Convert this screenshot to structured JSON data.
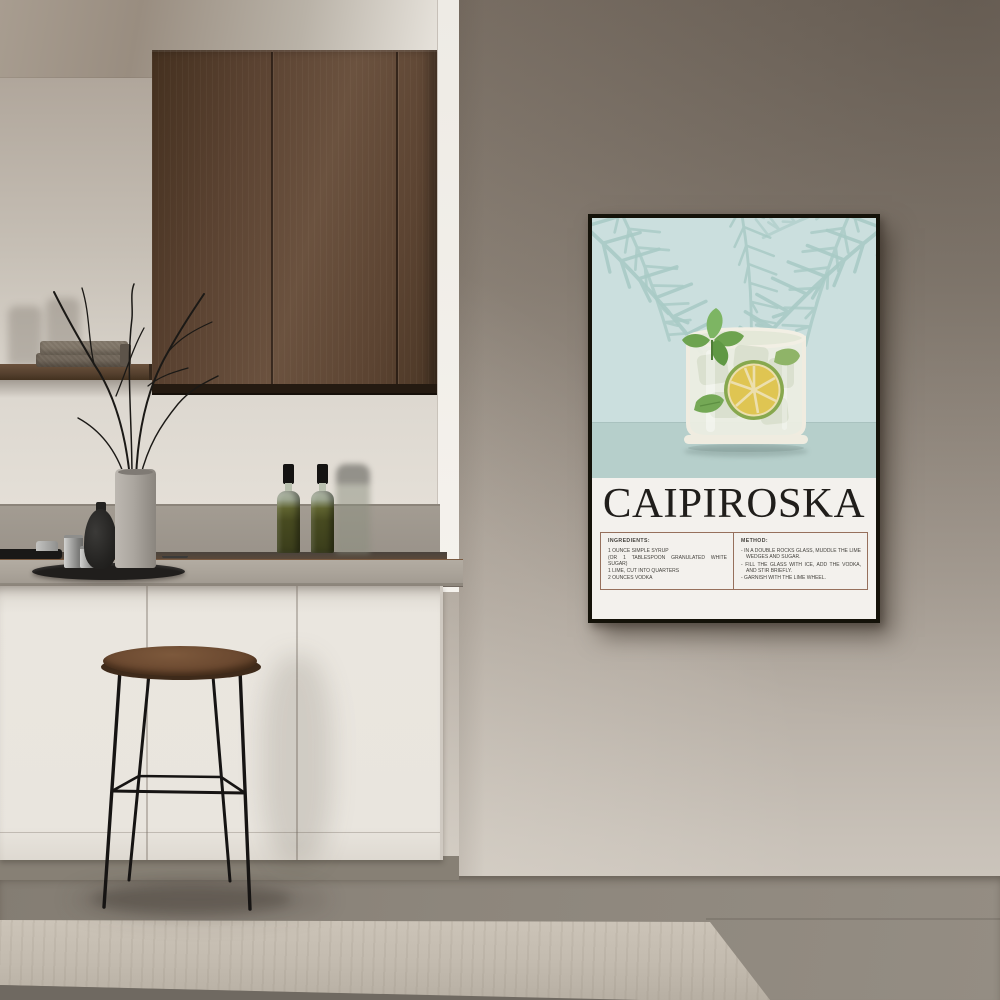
{
  "poster": {
    "title": "CAIPIROSKA",
    "ingredients": {
      "header": "INGREDIENTS:",
      "lines": [
        "1 OUNCE SIMPLE SYRUP",
        "(OR 1 TABLESPOON GRANULATED WHITE SUGAR)",
        "1 LIME, CUT INTO QUARTERS",
        "2 OUNCES VODKA"
      ]
    },
    "method": {
      "header": "METHOD:",
      "steps": [
        "- IN A DOUBLE ROCKS GLASS, MUDDLE THE LIME WEDGES AND SUGAR.",
        "- FILL THE GLASS WITH ICE, ADD THE VODKA, AND STIR BRIEFLY.",
        "- GARNISH WITH THE LIME WHEEL."
      ]
    },
    "artwork": {
      "glass_icon": "rocks-glass-with-lime-mint-and-ice",
      "leaf_icon": "palm-frond",
      "colors": {
        "background": "#cbdfde",
        "table_band": "#b6cfcb",
        "panel": "#f3f1ed",
        "frond": "#a9cbc6",
        "lime_rind": "#87a84e",
        "lime_flesh": "#dfc552",
        "mint": "#6da34f",
        "glass": "#efece0",
        "frame": "#141209",
        "box_border": "#96705c",
        "title_color": "#201e1b"
      }
    }
  },
  "room": {
    "colors": {
      "wall": "#a79e94",
      "alcove_wall": "#cfc9c0",
      "ceiling": "#a89d90",
      "cabinet_wood": "#5d4533",
      "backsplash": "#9e978d",
      "counter": "#aba49a",
      "base_cabinet": "#eae6df",
      "floor": "#8b847a",
      "step_riser": "#c4bcb0",
      "stool_seat": "#6b4a33",
      "oil_bottle": "#4c4e24",
      "towels": "#7c7266",
      "tray": "#201e1c"
    }
  }
}
